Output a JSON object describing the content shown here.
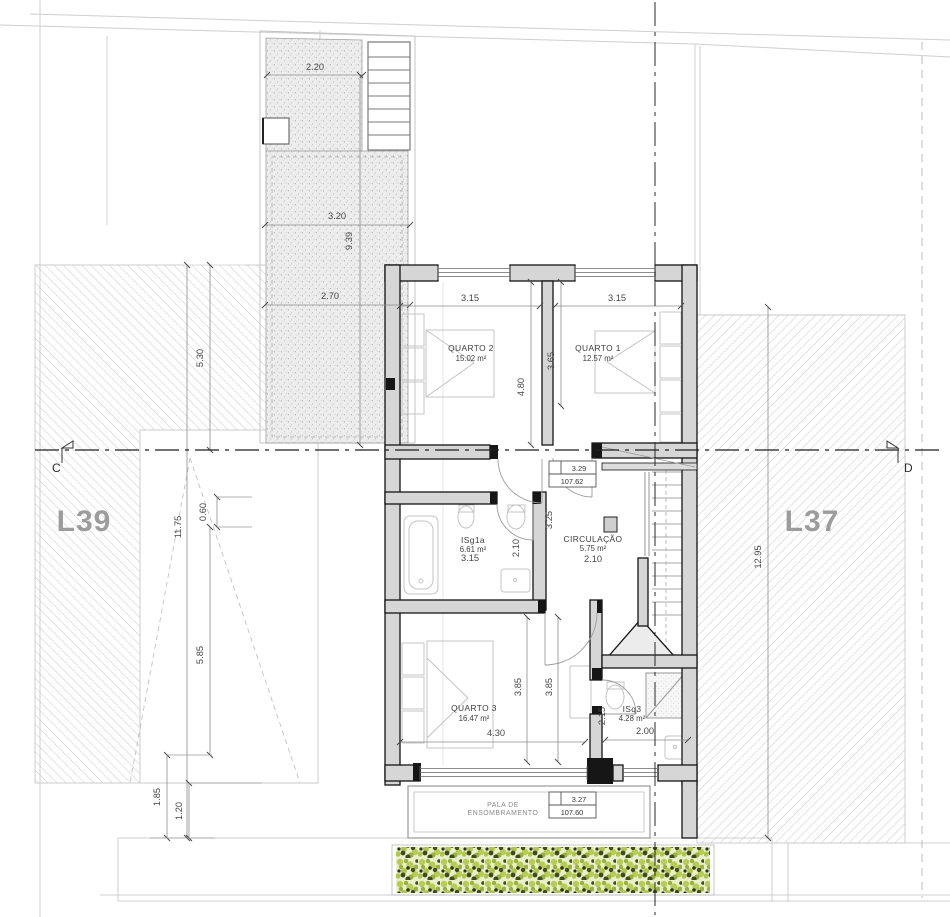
{
  "plan": {
    "lots": {
      "left": "L39",
      "right": "L37"
    },
    "sections": {
      "left": "C",
      "right": "D"
    },
    "rooms": {
      "quarto2": {
        "name": "QUARTO 2",
        "area": "15.02 m²"
      },
      "quarto1": {
        "name": "QUARTO 1",
        "area": "12.57 m²"
      },
      "isg1a": {
        "name": "ISg1a",
        "area": "6.61 m²"
      },
      "circulacao": {
        "name": "CIRCULAÇÃO",
        "area": "5.75 m²"
      },
      "quarto3": {
        "name": "QUARTO 3",
        "area": "16.47 m²"
      },
      "isq3": {
        "name": "ISq3",
        "area": "4.28 m²"
      }
    },
    "levels": {
      "upper": {
        "rel": "3.29",
        "abs": "107.62"
      },
      "lower": {
        "rel": "3.27",
        "abs": "107.60"
      }
    },
    "canopy": {
      "line1": "PALA DE",
      "line2": "ENSOMBRAMENTO"
    },
    "dims": {
      "patio_top": "2.20",
      "patio_mid": "3.20",
      "patio_height": "9.39",
      "patio_low": "2.70",
      "left_upper": "5.30",
      "left_total": "11.75",
      "left_small": "0.60",
      "left_lower": "5.85",
      "left_bottom_a": "1.85",
      "left_bottom_b": "1.20",
      "right_total": "12.95",
      "q2_width": "3.15",
      "q1_width": "3.15",
      "q2_depth": "4.80",
      "q1_depth": "3.65",
      "isg_width": "3.15",
      "isg_depth": "2.10",
      "hall_width": "2.10",
      "hall_depth": "3.25",
      "q3_depth_a": "3.85",
      "q3_depth_b": "3.85",
      "q3_width": "4.30",
      "isq3_depth": "2.15",
      "isq3_width": "2.00"
    },
    "colors": {
      "wall_fill": "#d6d6d6",
      "line": "#141414",
      "dimension_text": "#474747",
      "lot_label": "#9c9c9c",
      "hatch": "#c3c3c3",
      "hedge_light": "#b7cc55",
      "hedge_dark": "#3d4b1d"
    }
  }
}
